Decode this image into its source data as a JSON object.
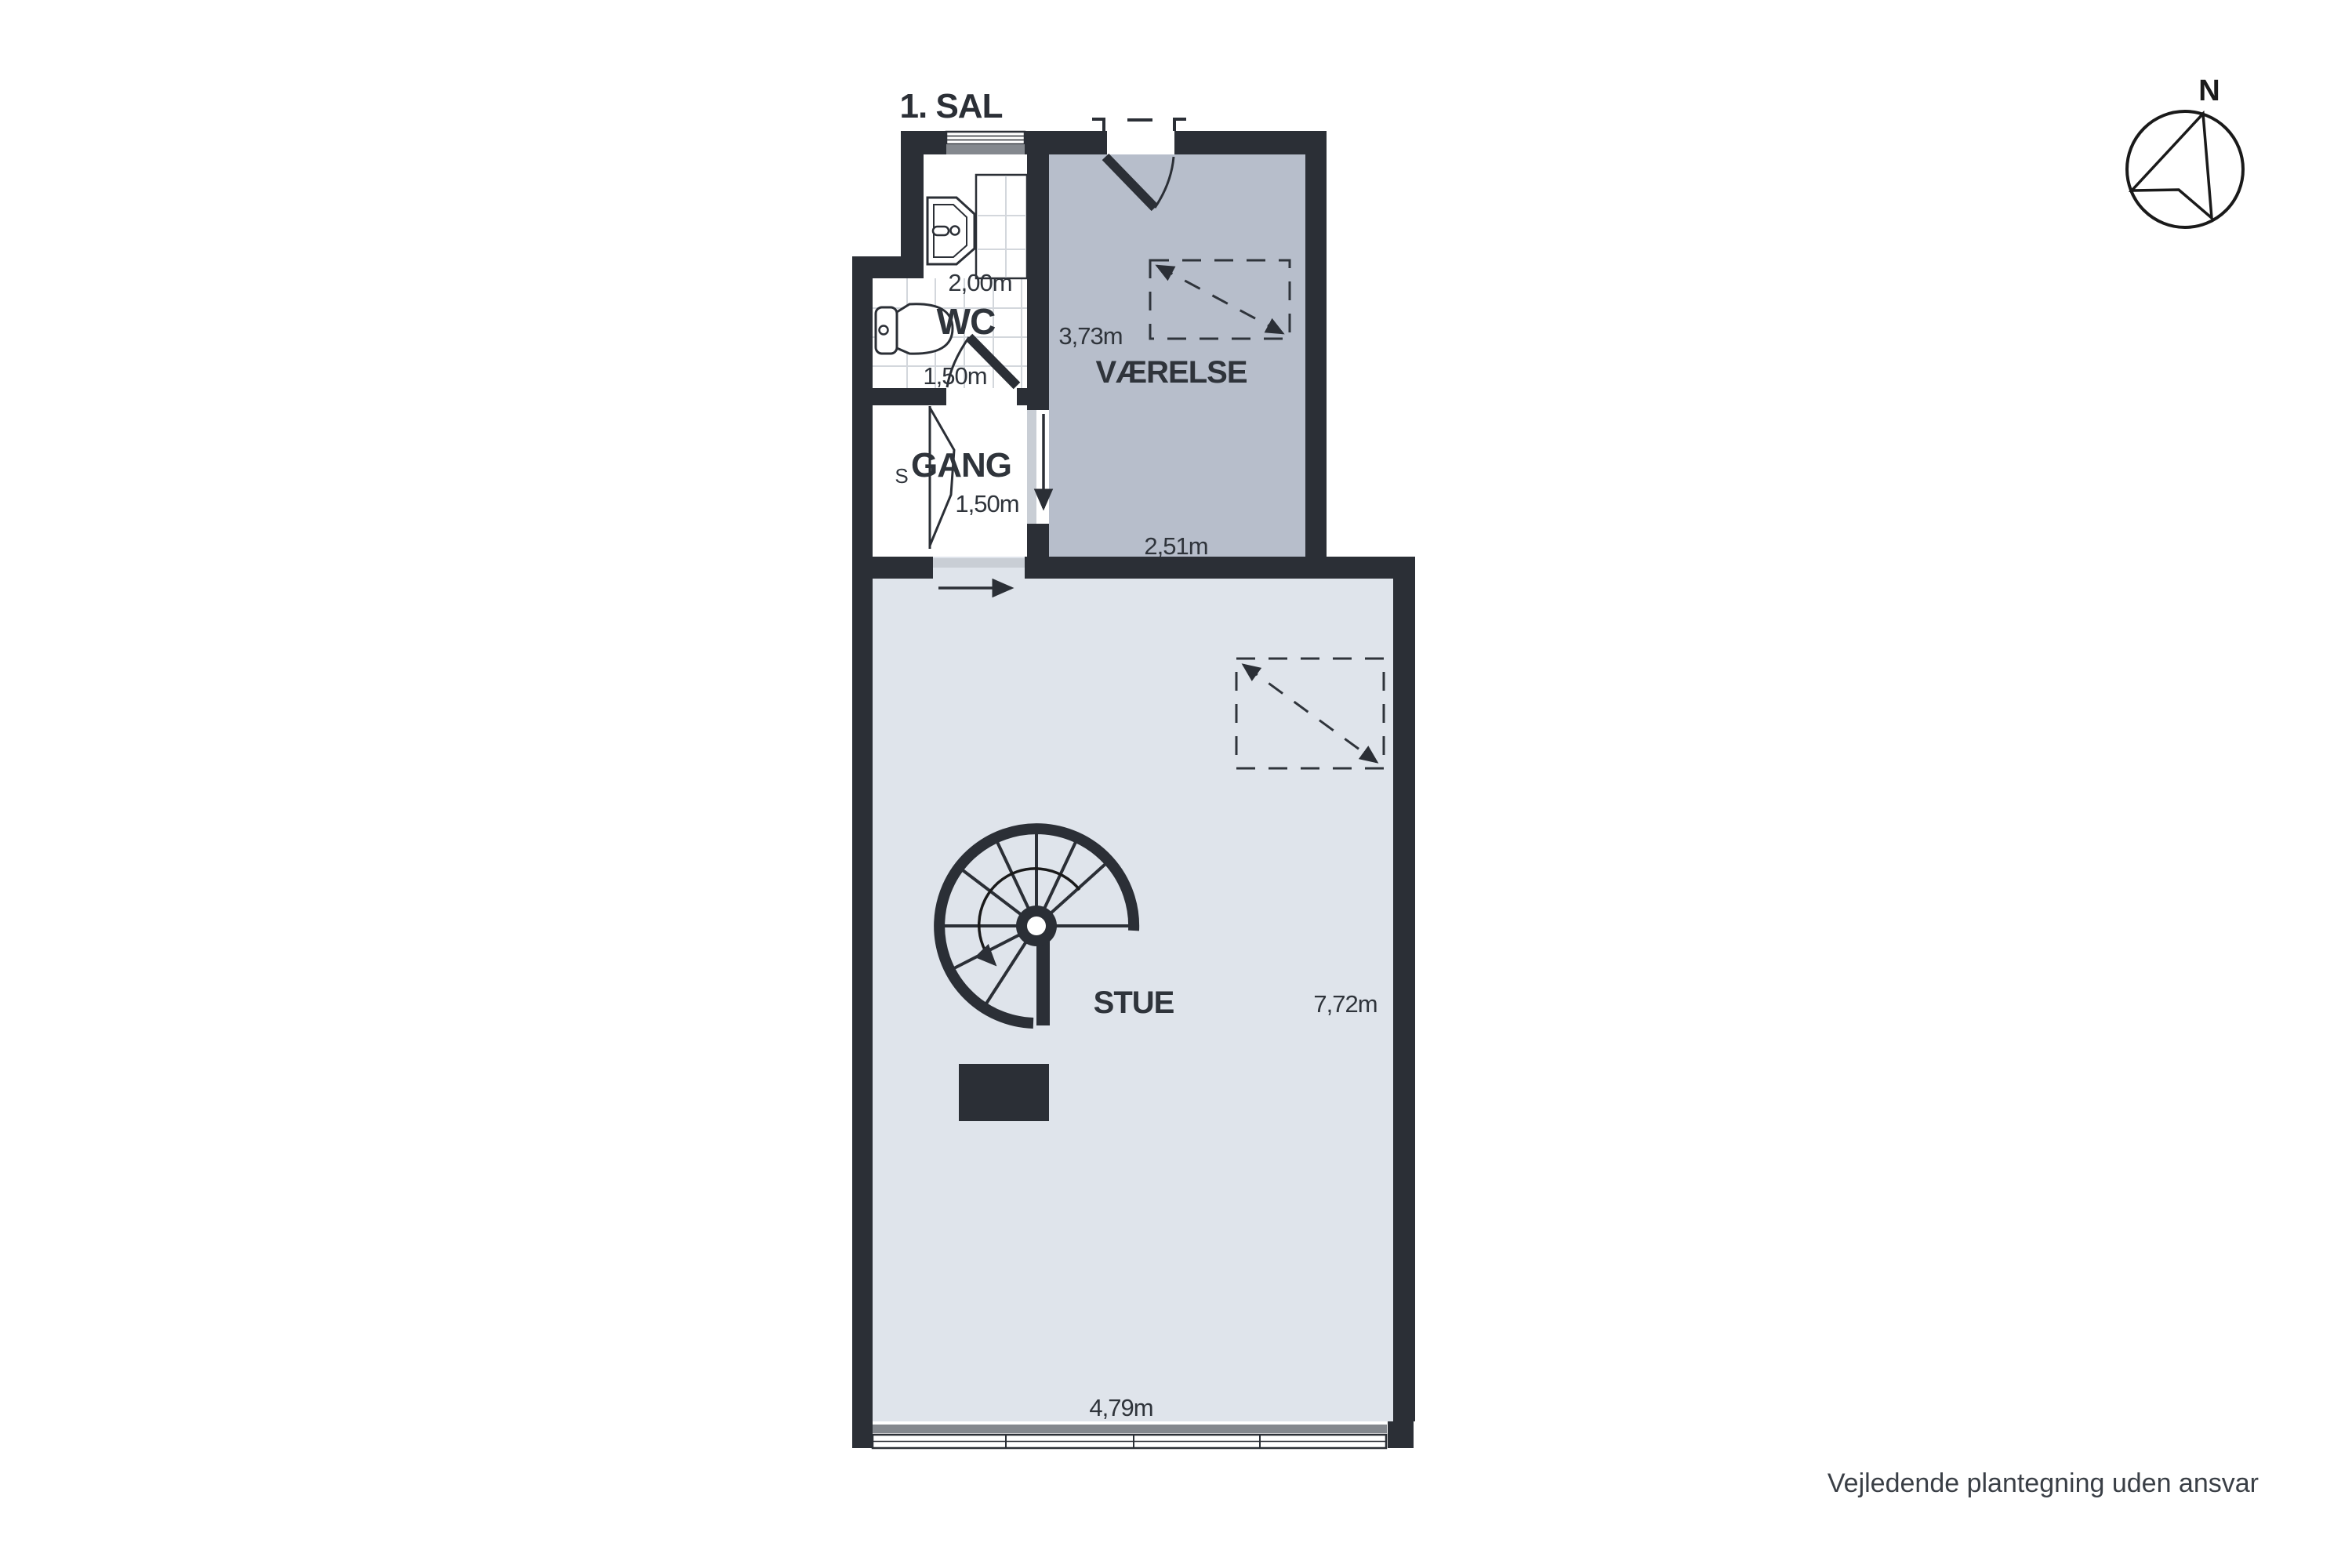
{
  "page": {
    "title": "1. SAL",
    "disclaimer": "Vejledende plantegning uden ansvar"
  },
  "compass": {
    "north": "N"
  },
  "rooms": {
    "bath": {
      "label": "WC",
      "width": "2,00m",
      "depth": "1,50m"
    },
    "gang": {
      "label": "GANG",
      "closet": "S",
      "width": "1,50m"
    },
    "vaerelse": {
      "label": "VÆRELSE",
      "depth": "3,73m",
      "width": "2,51m"
    },
    "stue": {
      "label": "STUE",
      "depth": "7,72m",
      "width": "4,79m"
    }
  },
  "colors": {
    "wall": "#2b2f36",
    "vaerelse_floor": "#b7becb",
    "stue_floor": "#dfe4eb",
    "sill": "#84888e",
    "sliding_panel": "#c9ced5",
    "tile_line": "#d3d7dc",
    "text": "#2f343b"
  }
}
